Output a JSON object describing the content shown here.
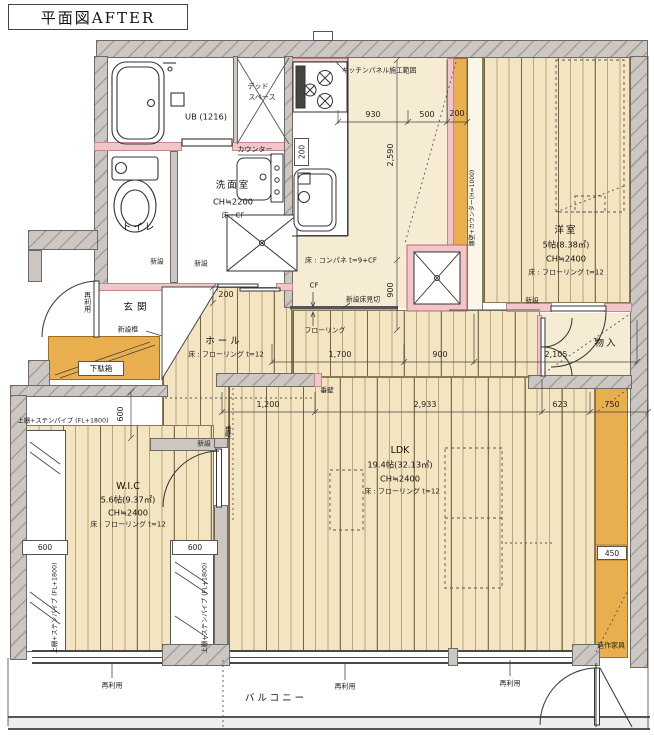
{
  "title": "平面図AFTER",
  "rooms": {
    "ub": {
      "label": "UB (1216)"
    },
    "dead_space": {
      "line1": "デッド",
      "line2": "スペース"
    },
    "washroom": {
      "name": "洗面室",
      "ch": "CH≒2200",
      "floor": "床 : CF"
    },
    "toilet": {
      "name": "トイレ"
    },
    "entrance": {
      "name": "玄関",
      "kamachi": "新設框",
      "shoe_box": "下駄箱"
    },
    "hall": {
      "name": "ホール",
      "floor": "床 : フローリング t=12"
    },
    "kitchen": {
      "panel_range": "キッチンパネル施工範囲",
      "floor": "床 : コンパネ t=9+CF",
      "counter": "カウンター"
    },
    "youshitsu": {
      "name": "洋室",
      "size": "5帖(8.38㎡)",
      "ch": "CH≒2400",
      "floor": "床 : フローリング t=12",
      "low_wall": "腰壁+カウンター(H=1000)"
    },
    "mono_ire": {
      "name": "物入"
    },
    "wic": {
      "name": "W.I.C",
      "size": "5.6帖(9.37㎡)",
      "ch": "CH≒2400",
      "floor": "床 : フローリング t=12",
      "shelf": "上棚+ステンパイプ (FL+1800)"
    },
    "ldk": {
      "name": "LDK",
      "size": "19.4帖(32.13㎡)",
      "ch": "CH≒2400",
      "floor": "床 : フローリング t=12"
    },
    "balcony": {
      "name": "バルコニー"
    },
    "furniture": {
      "label": "造作家具"
    }
  },
  "annotations": {
    "shinsetsu": "新設",
    "sairiyou": "再利用",
    "tarekabe": "垂壁",
    "flooring": "フローリング",
    "cf": "CF",
    "floor_edge": "新設床見切"
  },
  "dimensions": {
    "d930": "930",
    "d500": "500",
    "d200": "200",
    "d2590": "2,590",
    "d900": "900",
    "d1700": "1,700",
    "d2105": "2,105",
    "d1200": "1,200",
    "d2933": "2,933",
    "d623": "623",
    "d750": "750",
    "d600": "600",
    "d450": "450"
  },
  "colors": {
    "wood": "#f3e5c1",
    "wood_line": "#bb9f6e",
    "orange": "#e9ae4d",
    "new_wall_pink": "#f2c6c8",
    "wall_gray": "#cbc6c2"
  }
}
